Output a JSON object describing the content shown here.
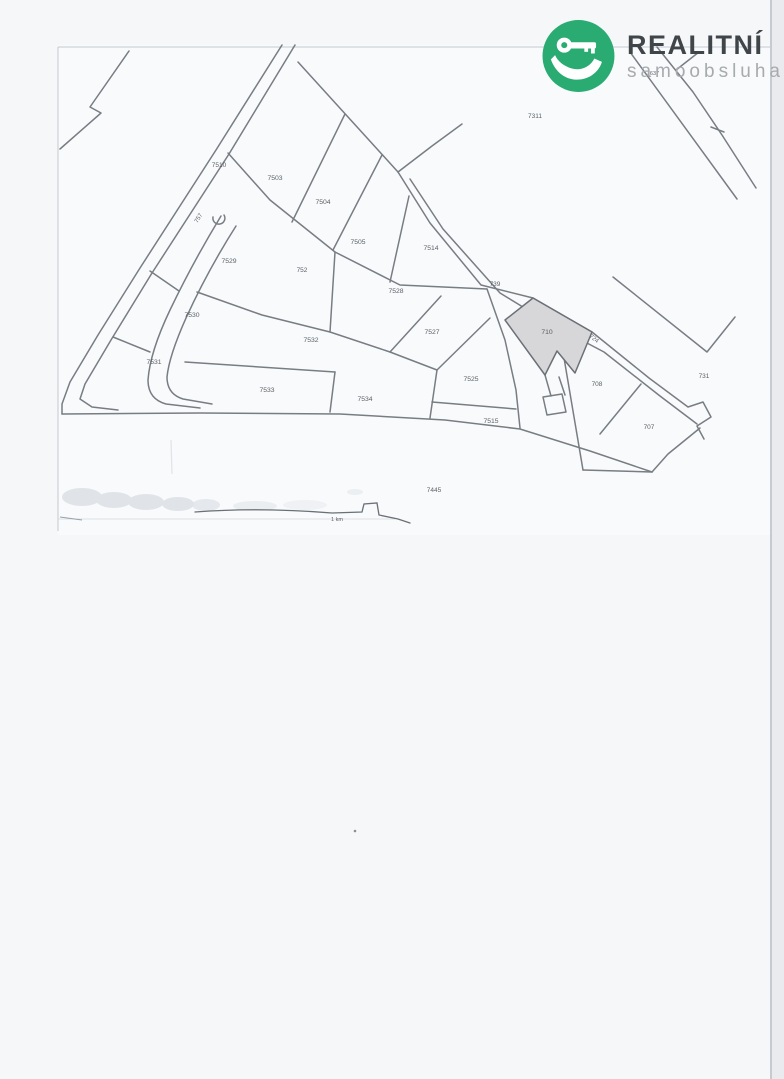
{
  "logo": {
    "brand": "REALITNÍ",
    "sub": "samoobsluha",
    "circle_color": "#29ab72",
    "icon": "key-in-hand-icon"
  },
  "map": {
    "type": "cadastral-plan-scan",
    "highlighted_parcel": "710",
    "highlight_color": "#d7d7d9",
    "line_color": "#6b7076",
    "scale_label": "1 km",
    "scale_label_pos": {
      "x": 337,
      "y": 521
    },
    "parcels": [
      {
        "id": "7637",
        "x": 653,
        "y": 75,
        "rot": 0,
        "size": 5.5
      },
      {
        "id": "7311",
        "x": 535,
        "y": 118,
        "rot": 0,
        "size": 6.5
      },
      {
        "id": "7510",
        "x": 219,
        "y": 167,
        "rot": 0,
        "size": 6.5
      },
      {
        "id": "7503",
        "x": 275,
        "y": 180,
        "rot": 0,
        "size": 6.8
      },
      {
        "id": "7504",
        "x": 323,
        "y": 204,
        "rot": 0,
        "size": 6.8
      },
      {
        "id": "757",
        "x": 200,
        "y": 219,
        "rot": -58,
        "size": 6
      },
      {
        "id": "7505",
        "x": 358,
        "y": 244,
        "rot": 0,
        "size": 6.8
      },
      {
        "id": "7514",
        "x": 431,
        "y": 250,
        "rot": 0,
        "size": 6.8
      },
      {
        "id": "7529",
        "x": 229,
        "y": 263,
        "rot": 0,
        "size": 6.8
      },
      {
        "id": "752",
        "x": 302,
        "y": 272,
        "rot": 0,
        "size": 6.5
      },
      {
        "id": "739",
        "x": 495,
        "y": 286,
        "rot": 0,
        "size": 6.5
      },
      {
        "id": "7528",
        "x": 396,
        "y": 293,
        "rot": 0,
        "size": 6.8
      },
      {
        "id": "7530",
        "x": 192,
        "y": 317,
        "rot": 0,
        "size": 6.8
      },
      {
        "id": "7527",
        "x": 432,
        "y": 334,
        "rot": 0,
        "size": 6.8
      },
      {
        "id": "710",
        "x": 547,
        "y": 334,
        "rot": 0,
        "size": 6.8
      },
      {
        "id": "724",
        "x": 593,
        "y": 340,
        "rot": 39,
        "size": 6
      },
      {
        "id": "7532",
        "x": 311,
        "y": 342,
        "rot": 0,
        "size": 6.8
      },
      {
        "id": "7531",
        "x": 154,
        "y": 364,
        "rot": 0,
        "size": 6.8
      },
      {
        "id": "731",
        "x": 704,
        "y": 378,
        "rot": 0,
        "size": 6.5
      },
      {
        "id": "7525",
        "x": 471,
        "y": 381,
        "rot": 0,
        "size": 6.8
      },
      {
        "id": "708",
        "x": 597,
        "y": 386,
        "rot": 0,
        "size": 6.5
      },
      {
        "id": "7533",
        "x": 267,
        "y": 392,
        "rot": 0,
        "size": 6.8
      },
      {
        "id": "7534",
        "x": 365,
        "y": 401,
        "rot": 0,
        "size": 6.8
      },
      {
        "id": "7515",
        "x": 491,
        "y": 423,
        "rot": 0,
        "size": 6.8
      },
      {
        "id": "707",
        "x": 649,
        "y": 429,
        "rot": 0,
        "size": 6.5
      },
      {
        "id": "7445",
        "x": 434,
        "y": 492,
        "rot": 0,
        "size": 6.5
      }
    ]
  }
}
